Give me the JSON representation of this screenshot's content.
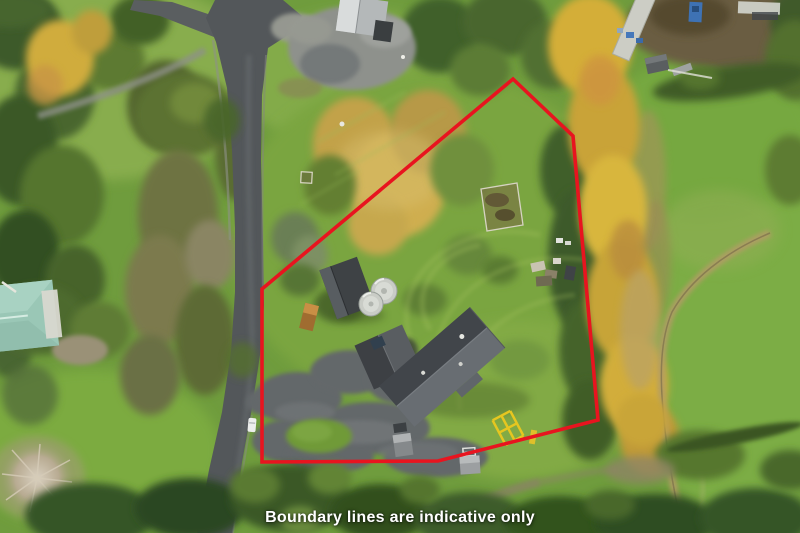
{
  "photo": {
    "type": "aerial-drone-photograph",
    "subject": "rural lifestyle property with main house, shed, two water tanks, paddocks, road at left and autumn trees at right",
    "palette": {
      "pasture_green": "#74a03e",
      "lawn_light_green": "#8ab050",
      "tree_dark_green": "#3a5826",
      "autumn_gold": "#d2ab3c",
      "road_asphalt": "#54585a",
      "gravel": "#8f928c",
      "house_roof_dark": "#45484c",
      "house_roof_light": "#686d72",
      "teal_roof": "#9ac7b6",
      "water_tank": "#cfd2cc",
      "farm_track_tan": "#b39c66"
    }
  },
  "overlay": {
    "caption": "Boundary lines are indicative only",
    "caption_color": "#ffffff",
    "boundary_color": "#e8141f",
    "boundary_stroke_width": "3.6",
    "boundary_points": "262,289 513,79 573,136 598,420 438,461 262,462"
  }
}
